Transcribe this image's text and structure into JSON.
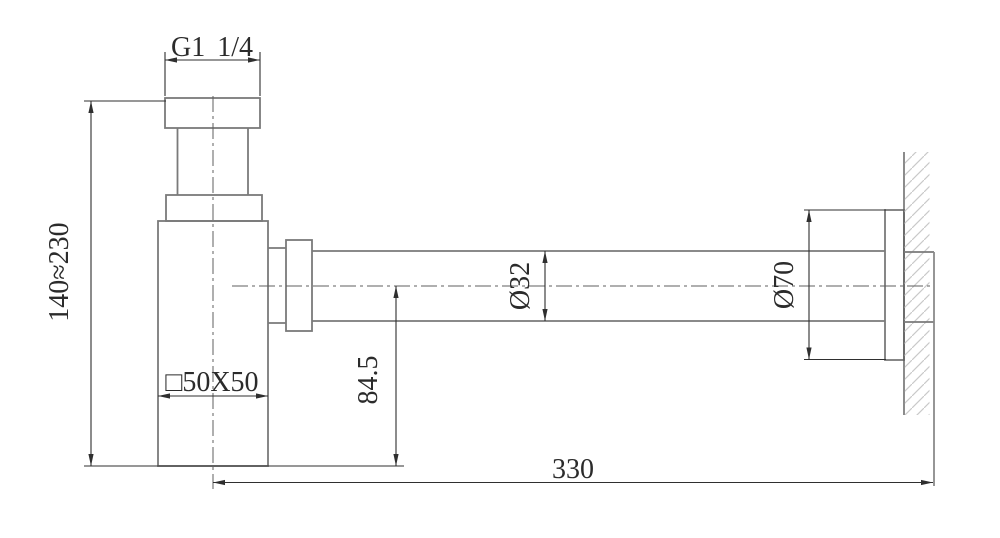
{
  "drawing": {
    "dimensions": {
      "thread_size": "G1 1/4",
      "height_range": "140≈230",
      "body_section": "□50X50",
      "outlet_center_height": "84.5",
      "pipe_diameter": "Ø32",
      "flange_diameter": "Ø70",
      "wall_distance": "330"
    },
    "colors": {
      "background": "#ffffff",
      "fixture_outline": "#7a7a7a",
      "dimension_lines": "#2f2f2f",
      "wall_hatch": "#c9c9c9"
    }
  }
}
